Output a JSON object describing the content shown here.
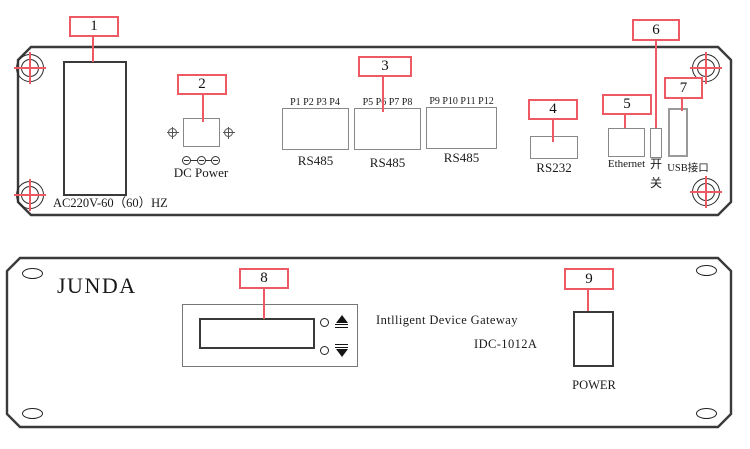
{
  "colors": {
    "accent": "#ee5a63",
    "outline": "#3a3a3a"
  },
  "callouts": [
    "1",
    "2",
    "3",
    "4",
    "5",
    "6",
    "7",
    "8",
    "9"
  ],
  "rear_panel": {
    "ac_inlet_label": "AC220V-60（60）HZ",
    "dc_power_label": "DC Power",
    "rs485_groups": [
      {
        "ports": "P1 P2 P3 P4",
        "label": "RS485"
      },
      {
        "ports": "P5 P6 P7 P8",
        "label": "RS485"
      },
      {
        "ports": "P9 P10 P11 P12",
        "label": "RS485"
      }
    ],
    "rs232_label": "RS232",
    "ethernet_label": "Ethernet",
    "switch_char_top": "开",
    "switch_char_bottom": "关",
    "usb_label": "USB接口"
  },
  "front_panel": {
    "brand": "JUNDA",
    "device_name": "Intlligent Device Gateway",
    "model": "IDC-1012A",
    "power_button_label": "POWER"
  }
}
